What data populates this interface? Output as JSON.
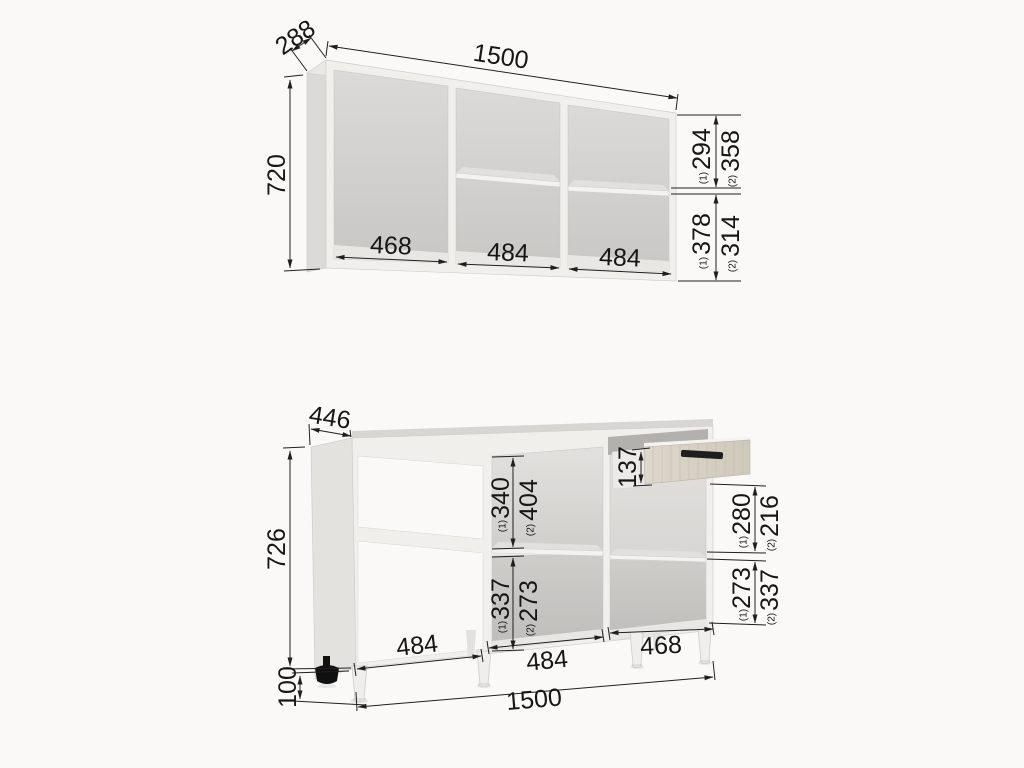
{
  "palette": {
    "background": "#faf9f7",
    "dimension_ink": "#1f1f1f",
    "cabinet_body": "#f0efec",
    "drawer_wood": "#d5cfc2",
    "handle": "#1e1e1e"
  },
  "sup": {
    "one": "(1)",
    "two": "(2)"
  },
  "wall_cabinet": {
    "width": "1500",
    "depth": "288",
    "height": "720",
    "inner_widths": [
      "468",
      "484",
      "484"
    ],
    "right_top": {
      "opt1": "294",
      "opt2": "358"
    },
    "right_bottom": {
      "opt1": "378",
      "opt2": "314"
    }
  },
  "base_cabinet": {
    "width": "1500",
    "depth": "446",
    "height": "726",
    "leg_height": "100",
    "drawer_height": "137",
    "mid_top": {
      "opt1": "340",
      "opt2": "404"
    },
    "mid_bottom": {
      "opt1": "337",
      "opt2": "273"
    },
    "right_top": {
      "opt1": "280",
      "opt2": "216"
    },
    "right_bottom": {
      "opt1": "273",
      "opt2": "337"
    },
    "inner_widths": [
      "484",
      "484",
      "468"
    ]
  }
}
